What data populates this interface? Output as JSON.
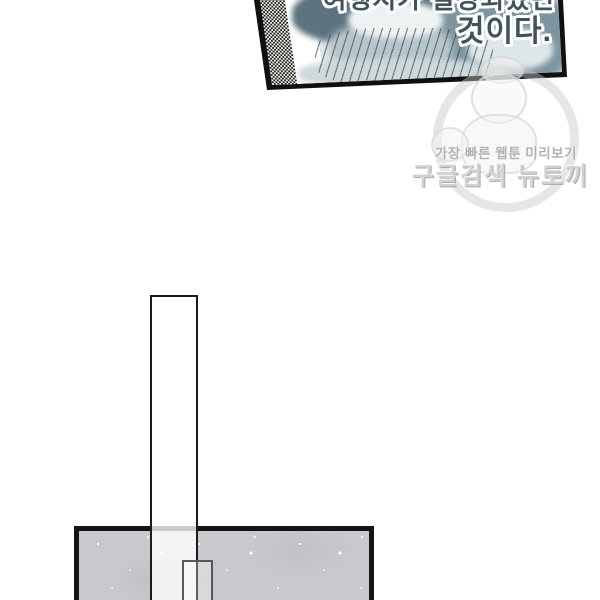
{
  "page": {
    "background_color": "#ffffff"
  },
  "top_panel": {
    "dialogue": {
      "line1": "여행지가 결정되었던",
      "line2": "것이다.",
      "text_color": "#42525b",
      "outline_color": "#ffffff"
    },
    "border_color": "#111111",
    "art": {
      "base_color": "#e2e8ea",
      "dark_tone": "#5d7380",
      "mid_tone": "#7e95a0",
      "light_tone": "#eef2f3"
    },
    "screentone": {
      "dot_color": "#1f1f1f",
      "base_color": "#f4f4ec"
    }
  },
  "watermark": {
    "tagline": "가장 빠른 웹툰 미리보기",
    "brand": "구글검색 뉴토끼",
    "color": "#c3c3c3"
  },
  "panels": {
    "vertical_panel": {
      "fill": "rgba(255,255,255,0.78)",
      "border_color": "#1b1b1b"
    },
    "bottom_panel": {
      "fill": "#c9c8cc",
      "border_color": "#141414"
    },
    "inner_rectangle": {
      "border_color": "#58585c"
    }
  }
}
